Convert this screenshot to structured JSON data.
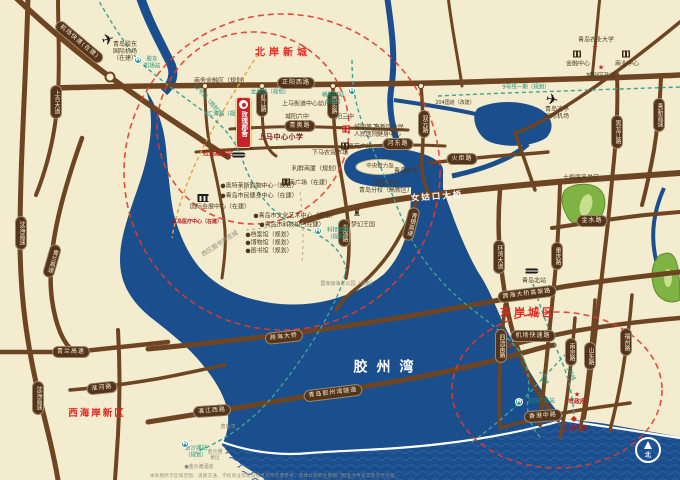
{
  "map": {
    "colors": {
      "land": "#F4ECCF",
      "water": "#1B4E8C",
      "road": "#6E4523",
      "pill_bg": "#54351B",
      "pill_text": "#F6EED2",
      "region_red": "#E02A22",
      "metro_teal": "#2E9C8C",
      "ring_red": "#E23B2E",
      "planned_orange": "#E6A23C",
      "project_red": "#C8232B",
      "scenic_green": "#7FB344"
    },
    "project": {
      "name": "玫瑰郡舍"
    },
    "compass": {
      "label": "北"
    },
    "disclaimer": "本地图所示区域范围、道路交通、学校商业等规划信息仅作示意参考，具体以政府主管部门批准文件及实际交付为准。",
    "bridge_label": {
      "t": "女姑口大桥",
      "x": 437,
      "y": 196,
      "r": -4
    },
    "region_labels": [
      {
        "t": "北岸新城",
        "x": 283,
        "y": 53,
        "fs": 10,
        "ls": 4,
        "n": "region-label-north-shore"
      },
      {
        "t": "东岸城区",
        "x": 528,
        "y": 313,
        "fs": 11,
        "ls": 3,
        "n": "region-label-east-shore"
      },
      {
        "t": "西海岸新区",
        "x": 97,
        "y": 414,
        "fs": 9.5,
        "ls": 2,
        "n": "region-label-west-coast"
      },
      {
        "t": "胶州湾",
        "x": 388,
        "y": 368,
        "fs": 14,
        "ls": 9,
        "cls": "bay",
        "n": "region-label-jiaozhou-bay"
      }
    ],
    "road_pills": [
      {
        "t": "正阳西路",
        "x": 296,
        "y": 83
      },
      {
        "t": "青奥路",
        "x": 300,
        "y": 126
      },
      {
        "t": "河东路",
        "x": 398,
        "y": 144
      },
      {
        "t": "火炬路",
        "x": 462,
        "y": 159
      },
      {
        "t": "金水路",
        "x": 592,
        "y": 221
      },
      {
        "t": "跨海大桥高架路",
        "x": 527,
        "y": 294,
        "r": -7
      },
      {
        "t": "机场快速路",
        "x": 533,
        "y": 336
      },
      {
        "t": "香港中路",
        "x": 543,
        "y": 416,
        "r": -4
      },
      {
        "t": "跨海大桥",
        "x": 284,
        "y": 337,
        "r": -6
      },
      {
        "t": "青岛胶州湾隧道",
        "x": 333,
        "y": 393,
        "r": -7
      },
      {
        "t": "青兰高速",
        "x": 71,
        "y": 352
      },
      {
        "t": "淮河路",
        "x": 102,
        "y": 388,
        "r": -6
      },
      {
        "t": "漓江西路",
        "x": 212,
        "y": 411,
        "r": -4
      },
      {
        "t": "机场快速(在建)",
        "x": 79,
        "y": 42,
        "r": 40
      },
      {
        "t": "上合大道",
        "x": 56,
        "y": 102,
        "v": 1
      },
      {
        "t": "虹江路",
        "x": 262,
        "y": 103,
        "v": 1
      },
      {
        "t": "岙东路",
        "x": 333,
        "y": 105,
        "v": 1
      },
      {
        "t": "双元路",
        "x": 424,
        "y": 124,
        "v": 1
      },
      {
        "t": "青银高速",
        "x": 411,
        "y": 224,
        "v": 1,
        "r": 14
      },
      {
        "t": "环湾大道",
        "x": 499,
        "y": 257,
        "v": 1
      },
      {
        "t": "黑龙江路",
        "x": 617,
        "y": 132,
        "v": 1
      },
      {
        "t": "青新高速",
        "x": 659,
        "y": 115,
        "v": 1
      },
      {
        "t": "重庆路",
        "x": 557,
        "y": 256,
        "v": 1
      },
      {
        "t": "四流南路",
        "x": 501,
        "y": 346,
        "v": 1
      },
      {
        "t": "南京路",
        "x": 571,
        "y": 352,
        "v": 1
      },
      {
        "t": "山东路",
        "x": 590,
        "y": 356,
        "v": 1
      },
      {
        "t": "福州路",
        "x": 626,
        "y": 342,
        "v": 1
      },
      {
        "t": "华强路",
        "x": 344,
        "y": 233,
        "v": 1
      },
      {
        "t": "沈海高速",
        "x": 21,
        "y": 233,
        "v": 1
      },
      {
        "t": "青兰高速",
        "x": 52,
        "y": 261,
        "v": 1,
        "r": 16
      },
      {
        "t": "沈海高速",
        "x": 38,
        "y": 398,
        "v": 1
      }
    ],
    "poi_labels": [
      {
        "t": "商务金融区（规划）",
        "x": 221,
        "y": 81
      },
      {
        "t": "上马街道中心幼儿园",
        "x": 309,
        "y": 104
      },
      {
        "t": "城阳六中",
        "x": 297,
        "y": 117
      },
      {
        "t": "城阳三中",
        "x": 342,
        "y": 117
      },
      {
        "t": "上马中心小学",
        "x": 281,
        "y": 137,
        "cls": "strong",
        "n": "poi-label-shangma-primary-school"
      },
      {
        "t": "城阳第二\n人民医院",
        "x": 366,
        "y": 131
      },
      {
        "t": "嘉苑广场",
        "x": 360,
        "y": 147
      },
      {
        "t": "下马农贸市场",
        "x": 330,
        "y": 153
      },
      {
        "t": "高新区全民\n健身中心",
        "x": 389,
        "y": 131
      },
      {
        "t": "204国道（改建）",
        "x": 455,
        "y": 103,
        "fs": 5
      },
      {
        "t": "利群商厦（规划）",
        "x": 316,
        "y": 169
      },
      {
        "t": "鲁商广场（在建）",
        "x": 307,
        "y": 183
      },
      {
        "t": "青岛中学",
        "x": 406,
        "y": 171
      },
      {
        "t": "清华附中\n青岛分校（高新区）",
        "x": 386,
        "y": 187
      },
      {
        "t": "方特梦幻王国",
        "x": 357,
        "y": 225
      },
      {
        "t": "十梅庵风景区",
        "x": 581,
        "y": 178
      },
      {
        "t": "青岛农业大学",
        "x": 596,
        "y": 40
      },
      {
        "t": "金融中心",
        "x": 578,
        "y": 64
      },
      {
        "t": "商业中心",
        "x": 627,
        "y": 64
      },
      {
        "t": "城阳区政府",
        "x": 601,
        "y": 76
      },
      {
        "t": "青岛流亭\n国际机场",
        "x": 557,
        "y": 113
      },
      {
        "t": "青岛胶东\n国际机场\n（在建）",
        "x": 125,
        "y": 52
      },
      {
        "t": "国际会展中心（在建）",
        "x": 220,
        "y": 207
      },
      {
        "t": "●奥特莱斯购物中心（规划）",
        "x": 259,
        "y": 186
      },
      {
        "t": "●青岛市民健身中心（在建）",
        "x": 259,
        "y": 196
      },
      {
        "t": "●青岛市文化艺术中心（规划）",
        "x": 295,
        "y": 216
      },
      {
        "t": "●青岛市科技馆（在建）",
        "x": 292,
        "y": 225
      },
      {
        "t": "●档案馆（规划）",
        "x": 269,
        "y": 235
      },
      {
        "t": "●博物馆（规划）",
        "x": 269,
        "y": 243
      },
      {
        "t": "●图书馆（规划）",
        "x": 269,
        "y": 251
      },
      {
        "t": "红岛医疗中心（在建）",
        "x": 197,
        "y": 222,
        "cls": "redname",
        "fs": 5
      },
      {
        "t": "红岛高铁站",
        "x": 218,
        "y": 154,
        "cls": "redname",
        "n": "poi-label-hongdao-station"
      },
      {
        "t": "国家级海洋公园（规划）",
        "x": 348,
        "y": 284,
        "cls": "gray",
        "fs": 5
      },
      {
        "t": "西区图书博览城",
        "x": 220,
        "y": 244,
        "cls": "gray",
        "r": -33
      },
      {
        "t": "唐岛湾",
        "x": 228,
        "y": 427,
        "cls": "gray",
        "fs": 5
      },
      {
        "t": "金沙滩\n景区",
        "x": 215,
        "y": 455,
        "cls": "gray",
        "fs": 5
      },
      {
        "t": "●金沙滩酒店",
        "x": 199,
        "y": 467,
        "cls": "gray",
        "fs": 5
      },
      {
        "t": "青岛北站",
        "x": 534,
        "y": 281,
        "n": "poi-label-qingdao-north-station"
      },
      {
        "t": "中央智力岛",
        "x": 380,
        "y": 167,
        "fs": 5.5
      },
      {
        "t": "市政府",
        "x": 577,
        "y": 402,
        "cls": "redname"
      },
      {
        "t": "五四广场",
        "x": 575,
        "y": 429,
        "cls": "redname",
        "n": "poi-label-may-fourth-square"
      }
    ],
    "metro_labels": [
      {
        "t": "胶东\n机场站",
        "x": 152,
        "y": 63
      },
      {
        "t": "12号线（规划）",
        "x": 207,
        "y": 100,
        "r": 48
      },
      {
        "t": "汇海路（规划）",
        "x": 227,
        "y": 115
      },
      {
        "t": "龙海路（规划）",
        "x": 270,
        "y": 93
      },
      {
        "t": "9号线一期（规划）",
        "x": 526,
        "y": 88
      },
      {
        "t": "朝阳村站\n（规划）",
        "x": 333,
        "y": 99
      },
      {
        "t": "科技馆站\n（规划）",
        "x": 338,
        "y": 234
      },
      {
        "t": "3号线",
        "x": 570,
        "y": 374,
        "r": 65
      },
      {
        "t": "2号线",
        "x": 543,
        "y": 378,
        "r": 65
      },
      {
        "t": "五四广场站",
        "x": 541,
        "y": 402
      },
      {
        "t": "金沙滩站\n（规划）",
        "x": 196,
        "y": 452
      }
    ],
    "icons": [
      {
        "type": "plane",
        "x": 108,
        "y": 40,
        "r": -15
      },
      {
        "type": "plane",
        "x": 552,
        "y": 100,
        "r": 10
      },
      {
        "type": "train",
        "x": 239,
        "y": 155
      },
      {
        "type": "train",
        "x": 532,
        "y": 271
      },
      {
        "type": "metro",
        "x": 138,
        "y": 60
      },
      {
        "type": "metro",
        "x": 352,
        "y": 91
      },
      {
        "type": "metro",
        "x": 318,
        "y": 231
      },
      {
        "type": "metro",
        "x": 519,
        "y": 402
      },
      {
        "type": "metro",
        "x": 185,
        "y": 444
      },
      {
        "type": "cross",
        "x": 346,
        "y": 129
      },
      {
        "type": "museum",
        "x": 203,
        "y": 198
      },
      {
        "type": "bldg",
        "x": 345,
        "y": 146
      },
      {
        "type": "bldg",
        "x": 286,
        "y": 182
      },
      {
        "type": "bldg",
        "x": 577,
        "y": 54
      },
      {
        "type": "bldg",
        "x": 626,
        "y": 54
      },
      {
        "type": "castle",
        "x": 357,
        "y": 214
      },
      {
        "type": "star",
        "x": 595,
        "y": 48
      },
      {
        "type": "star",
        "x": 601,
        "y": 68
      },
      {
        "type": "star",
        "x": 577,
        "y": 395
      },
      {
        "type": "diamond",
        "x": 574,
        "y": 419
      }
    ]
  }
}
